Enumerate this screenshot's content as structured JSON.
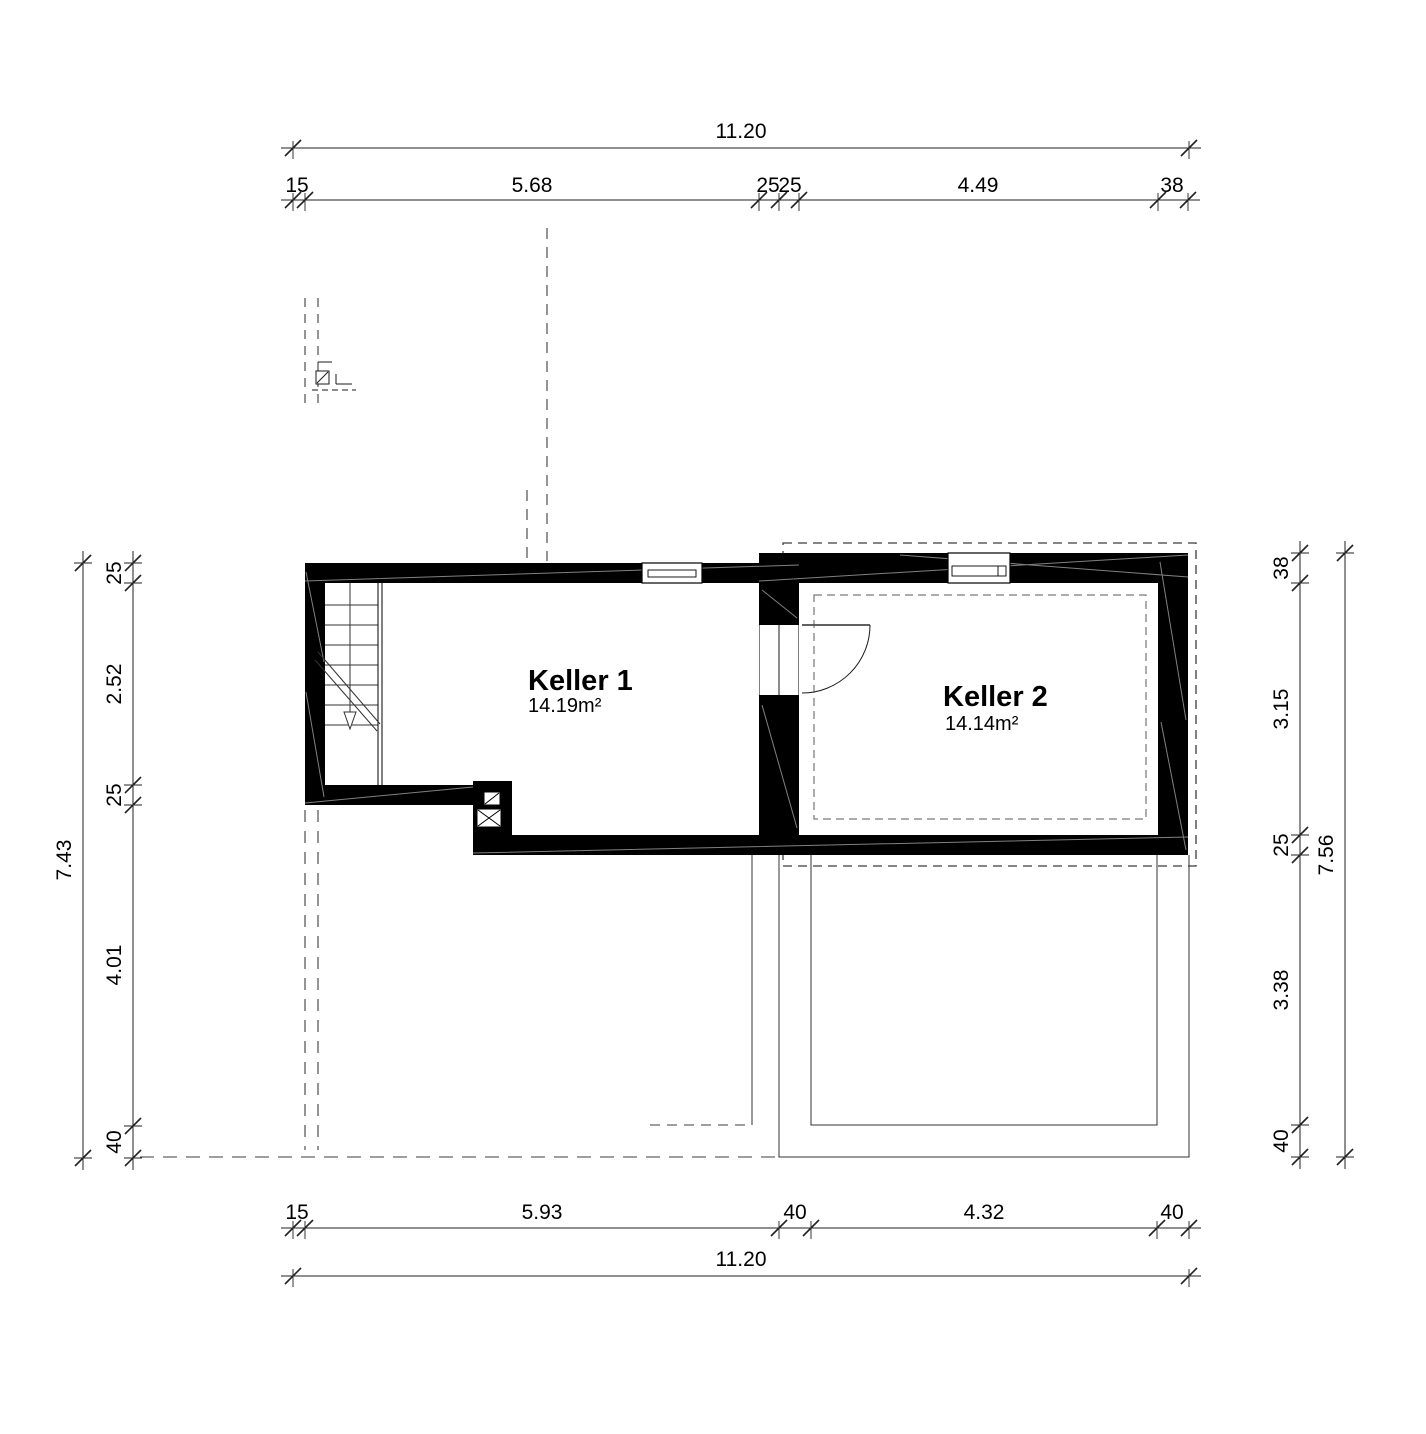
{
  "plan": {
    "rooms": [
      {
        "name": "Keller 1",
        "area": "14.19m²"
      },
      {
        "name": "Keller 2",
        "area": "14.14m²"
      }
    ],
    "dimensions": {
      "top": {
        "total": "11.20",
        "segments": [
          "15",
          "5.68",
          "25",
          "25",
          "4.49",
          "38"
        ]
      },
      "bottom": {
        "total": "11.20",
        "segments": [
          "15",
          "5.93",
          "40",
          "4.32",
          "40"
        ]
      },
      "left": {
        "total": "7.43",
        "segments": [
          "25",
          "2.52",
          "25",
          "4.01",
          "40"
        ]
      },
      "right": {
        "total": "7.56",
        "segments": [
          "38",
          "3.15",
          "25",
          "3.38",
          "40"
        ]
      }
    },
    "colors": {
      "background": "#ffffff",
      "wall": "#000000",
      "line": "#1a1a1a",
      "dashed": "#3c3c3c"
    }
  }
}
